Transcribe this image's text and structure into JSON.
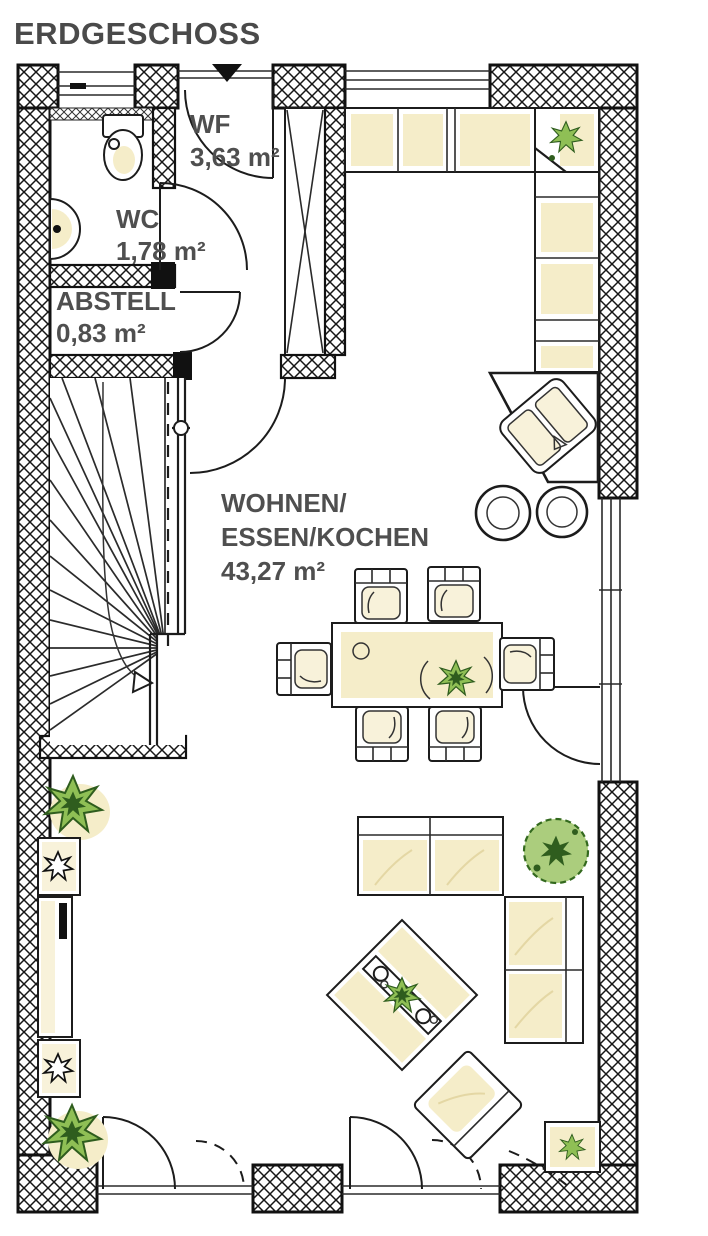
{
  "title": "ERDGESCHOSS",
  "rooms": {
    "wf": {
      "label": "WF",
      "area": "3,63 m²"
    },
    "wc": {
      "label": "WC",
      "area": "1,78 m²"
    },
    "abstell": {
      "label": "ABSTELL",
      "area": "0,83 m²"
    },
    "wohnen": {
      "label_line1": "WOHNEN/",
      "label_line2": "ESSEN/KOCHEN",
      "area": "43,27 m²"
    }
  },
  "colors": {
    "wall_line": "#111111",
    "label_text": "#4f4f4f",
    "furniture_beige": "#f5edc9",
    "plant_green": "#8fbf55",
    "plant_green_dark": "#2f5d1e"
  },
  "symbols": [
    "entrance-arrow",
    "toilet",
    "washbasin",
    "winder-staircase",
    "shaft-cross",
    "kitchen-counter",
    "kitchen-sink",
    "bar-stool",
    "dining-table",
    "dining-chair",
    "sofa",
    "round-plant",
    "coffee-table",
    "armchair",
    "tv-sideboard",
    "plant"
  ]
}
